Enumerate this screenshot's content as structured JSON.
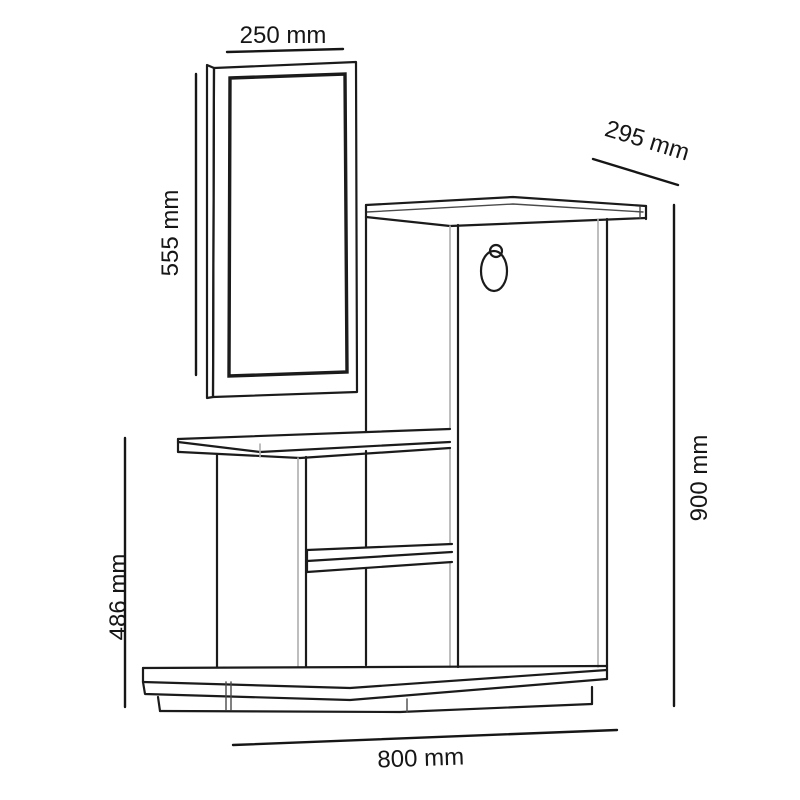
{
  "diagram": {
    "unit": "mm",
    "colors": {
      "line": "#1b1b1b",
      "joint_line": "#aeaeae",
      "dimension_text": "#161616",
      "background": "#ffffff"
    },
    "dimensions": {
      "mirror_width": {
        "label": "250 mm",
        "value": 250
      },
      "mirror_height": {
        "label": "555 mm",
        "value": 555
      },
      "cabinet_depth": {
        "label": "295 mm",
        "value": 295
      },
      "total_height": {
        "label": "900 mm",
        "value": 900
      },
      "desk_height": {
        "label": "486 mm",
        "value": 486
      },
      "total_width": {
        "label": "800 mm",
        "value": 800
      }
    }
  }
}
